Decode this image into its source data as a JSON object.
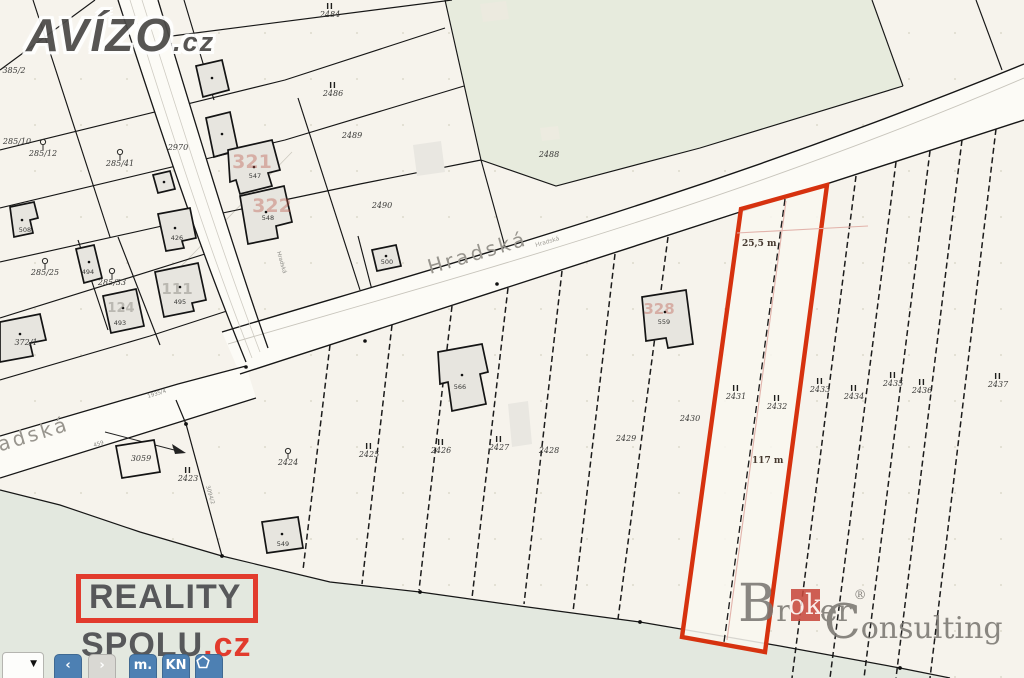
{
  "colors": {
    "highlight_red": "#d6320f",
    "measure_pink": "#e2b3ab",
    "logo_red": "#e23b2d",
    "broker_red": "#c94a3e",
    "toolbar_blue": "#4d80b3",
    "map_bg": "#f6f3ec",
    "forest_green": "#e7ebdd",
    "meadow_green": "#e3e8df"
  },
  "map": {
    "street_main": "Hradská",
    "street_main_small": "Hradská",
    "street_left": "Hradská",
    "street_left_number": "459",
    "street_side_small": "Hradská",
    "road_side_parcel": "1935/4",
    "path_parcel": "3094/2",
    "measurement_width": "25,5 m",
    "measurement_length": "117 m",
    "parcel_labels": [
      {
        "text": "2484",
        "x": 330,
        "y": 17,
        "sym": "II"
      },
      {
        "text": "2486",
        "x": 333,
        "y": 96,
        "sym": "II"
      },
      {
        "text": "2489",
        "x": 352,
        "y": 138
      },
      {
        "text": "2488",
        "x": 549,
        "y": 157
      },
      {
        "text": "2490",
        "x": 382,
        "y": 208
      },
      {
        "text": "2970",
        "x": 178,
        "y": 150
      },
      {
        "text": "385/2",
        "x": 14,
        "y": 73
      },
      {
        "text": "285/10",
        "x": 17,
        "y": 144
      },
      {
        "text": "285/12",
        "x": 43,
        "y": 156,
        "sym": "tree"
      },
      {
        "text": "285/41",
        "x": 120,
        "y": 166,
        "sym": "tree"
      },
      {
        "text": "285/25",
        "x": 45,
        "y": 275,
        "sym": "tree"
      },
      {
        "text": "285/33",
        "x": 112,
        "y": 285,
        "sym": "tree"
      },
      {
        "text": "372/1",
        "x": 26,
        "y": 345
      },
      {
        "text": "2423",
        "x": 188,
        "y": 481,
        "sym": "II"
      },
      {
        "text": "2424",
        "x": 288,
        "y": 465,
        "sym": "tree"
      },
      {
        "text": "2425",
        "x": 369,
        "y": 457,
        "sym": "II"
      },
      {
        "text": "2426",
        "x": 441,
        "y": 453,
        "sym": "II"
      },
      {
        "text": "2427",
        "x": 499,
        "y": 450,
        "sym": "II"
      },
      {
        "text": "2428",
        "x": 549,
        "y": 453
      },
      {
        "text": "2429",
        "x": 626,
        "y": 441
      },
      {
        "text": "2430",
        "x": 690,
        "y": 421
      },
      {
        "text": "2431",
        "x": 736,
        "y": 399,
        "sym": "II"
      },
      {
        "text": "2432",
        "x": 777,
        "y": 409,
        "sym": "II"
      },
      {
        "text": "2433",
        "x": 820,
        "y": 392,
        "sym": "II"
      },
      {
        "text": "2434",
        "x": 854,
        "y": 399,
        "sym": "II"
      },
      {
        "text": "2435",
        "x": 893,
        "y": 386,
        "sym": "II"
      },
      {
        "text": "2436",
        "x": 922,
        "y": 393,
        "sym": "II"
      },
      {
        "text": "2437",
        "x": 998,
        "y": 387,
        "sym": "II"
      },
      {
        "text": "3059",
        "x": 141,
        "y": 461
      }
    ],
    "building_labels": [
      {
        "text": "508",
        "x": 25,
        "y": 232
      },
      {
        "text": "426",
        "x": 177,
        "y": 240
      },
      {
        "text": "494",
        "x": 88,
        "y": 274
      },
      {
        "text": "493",
        "x": 120,
        "y": 325
      },
      {
        "text": "495",
        "x": 180,
        "y": 304
      },
      {
        "text": "547",
        "x": 255,
        "y": 178
      },
      {
        "text": "548",
        "x": 268,
        "y": 220
      },
      {
        "text": "500",
        "x": 387,
        "y": 264
      },
      {
        "text": "566",
        "x": 460,
        "y": 389
      },
      {
        "text": "559",
        "x": 664,
        "y": 324
      },
      {
        "text": "549",
        "x": 283,
        "y": 546
      }
    ],
    "house_number_watermarks": [
      {
        "text": "321",
        "x": 252,
        "y": 168,
        "color": "pink",
        "size": 19
      },
      {
        "text": "322",
        "x": 272,
        "y": 212,
        "color": "pink",
        "size": 19
      },
      {
        "text": "328",
        "x": 659,
        "y": 314,
        "color": "pink",
        "size": 15
      },
      {
        "text": "111",
        "x": 177,
        "y": 294,
        "color": "gray",
        "size": 15
      },
      {
        "text": "124",
        "x": 121,
        "y": 312,
        "color": "gray",
        "size": 13
      }
    ]
  },
  "logos": {
    "avizo": {
      "name": "AVÍZO",
      "tld": ".cz"
    },
    "reality_spolu": {
      "line1": "REALITY",
      "line2": "SPOLU",
      "tld": ".cz"
    },
    "broker_consulting": {
      "b": "B",
      "pre": "r",
      "highlight": "ok",
      "post": "er",
      "registered": "®",
      "c": "C",
      "rest": "onsulting"
    }
  },
  "toolbar": {
    "dropdown_icon": "▼",
    "buttons": [
      {
        "id": "prev",
        "label": "‹",
        "variant": "blue"
      },
      {
        "id": "next",
        "label": "›",
        "variant": "gray"
      },
      {
        "id": "measure-m",
        "label": "m.",
        "variant": "blue"
      },
      {
        "id": "kn",
        "label": "KN",
        "variant": "blue"
      },
      {
        "id": "polygon",
        "label": "",
        "variant": "blue",
        "icon": "pentagon"
      }
    ]
  }
}
